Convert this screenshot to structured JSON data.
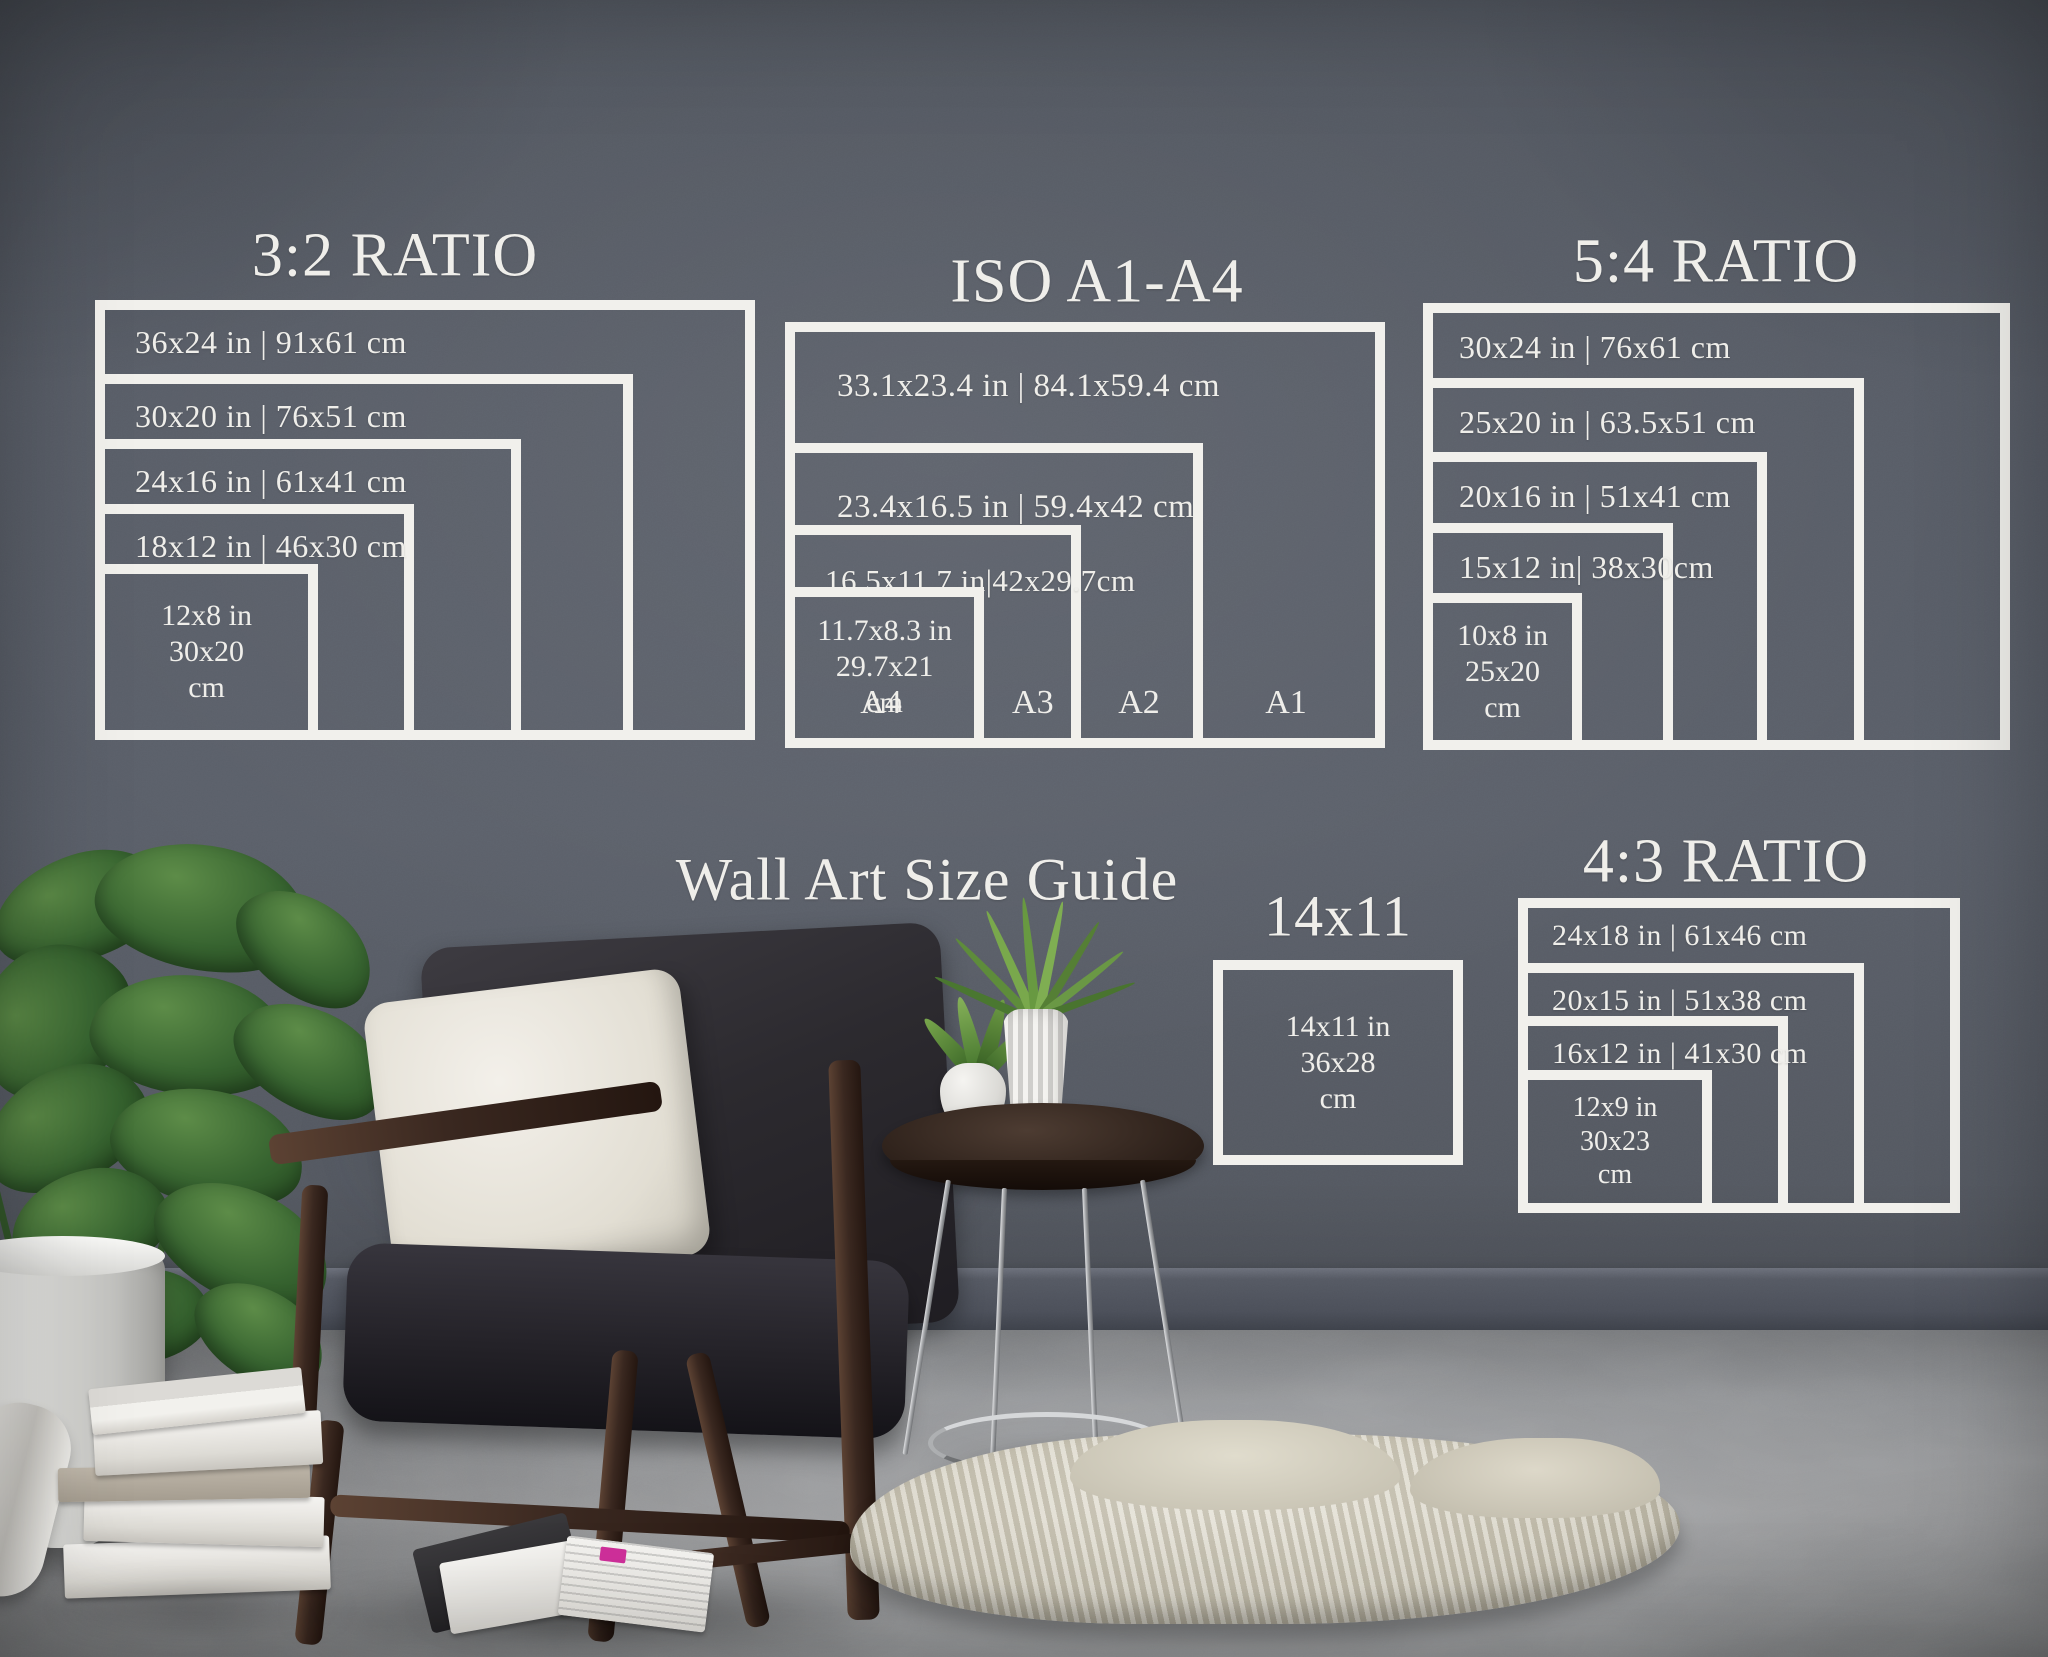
{
  "titles": {
    "main": "Wall Art Size Guide"
  },
  "groups": {
    "ratio32": {
      "title": "3:2 RATIO",
      "frames": [
        {
          "label": "36x24 in | 91x61 cm"
        },
        {
          "label": "30x20 in | 76x51 cm"
        },
        {
          "label": "24x16 in | 61x41 cm"
        },
        {
          "label": "18x12 in | 46x30 cm"
        },
        {
          "lines": [
            "12x8 in",
            "30x20",
            "cm"
          ]
        }
      ]
    },
    "iso": {
      "title": "ISO A1-A4",
      "frames": [
        {
          "label": "33.1x23.4 in | 84.1x59.4 cm"
        },
        {
          "label": "23.4x16.5 in | 59.4x42 cm"
        },
        {
          "label": "16.5x11.7 in|42x29.7cm"
        },
        {
          "lines": [
            "11.7x8.3 in",
            "29.7x21",
            "cm"
          ]
        }
      ],
      "corner_labels": [
        "A4",
        "A3",
        "A2",
        "A1"
      ]
    },
    "ratio54": {
      "title": "5:4 RATIO",
      "frames": [
        {
          "label": "30x24 in | 76x61 cm"
        },
        {
          "label": "25x20 in | 63.5x51 cm"
        },
        {
          "label": "20x16 in | 51x41 cm"
        },
        {
          "label": "15x12 in| 38x30cm"
        },
        {
          "lines": [
            "10x8 in",
            "25x20",
            "cm"
          ]
        }
      ]
    },
    "size1411": {
      "title": "14x11",
      "frames": [
        {
          "lines": [
            "14x11 in",
            "36x28",
            "cm"
          ]
        }
      ]
    },
    "ratio43": {
      "title": "4:3 RATIO",
      "frames": [
        {
          "label": "24x18 in | 61x46 cm"
        },
        {
          "label": "20x15 in | 51x38 cm"
        },
        {
          "label": "16x12 in | 41x30 cm"
        },
        {
          "lines": [
            "12x9 in",
            "30x23",
            "cm"
          ]
        }
      ]
    }
  },
  "colors": {
    "wall": "#575c66",
    "floor": "#919395",
    "frame_white": "#f1f0ec",
    "text_white": "#efeeea",
    "cushion_dark": "#2b292d",
    "wood_dark": "#3a2820",
    "pillow_white": "#e9e6df",
    "plant_green": "#3c6a33",
    "rug_cream": "#d6d2c4",
    "magazine_accent": "#cf2f9a"
  },
  "scene_objects": [
    "monstera-plant",
    "white-planter",
    "wooden-armchair",
    "white-throw-pillow",
    "round-side-table",
    "potted-succulent",
    "fluted-white-vase",
    "stack-of-white-books",
    "open-magazine",
    "cream-sheepskin-rug"
  ]
}
